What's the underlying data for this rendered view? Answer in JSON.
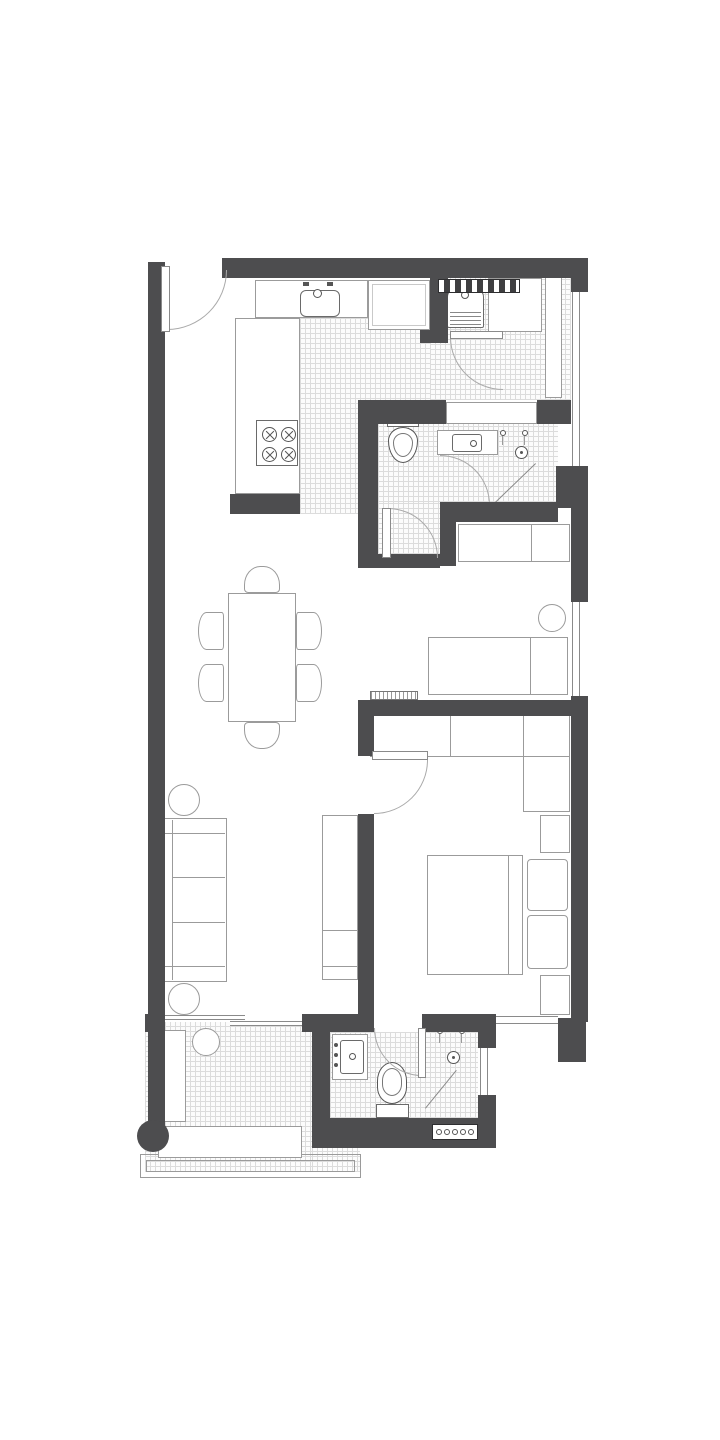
{
  "title": "two-bedroom apartment floor plan",
  "figure_type": "architectural floor plan, top-down, black and white",
  "colors": {
    "bg": "#ffffff",
    "wall": "#4d4d4f",
    "line": "#9b9b9b",
    "fix": "#6a6a6a",
    "tile": "#dcdcdc"
  },
  "rooms": [
    {
      "id": "entry",
      "fixtures": [
        "entry-door-swing"
      ]
    },
    {
      "id": "kitchen",
      "floor": "tile",
      "fixtures": [
        "l-shaped-counter",
        "sink-with-taps",
        "fridge",
        "cooktop-4-burners"
      ]
    },
    {
      "id": "laundry",
      "floor": "tile",
      "fixtures": [
        "vent-grille",
        "washing-machine",
        "storage-box",
        "tall-cabinet",
        "door-swing"
      ]
    },
    {
      "id": "bathroom-1",
      "floor": "tile",
      "fixtures": [
        "recessed-shelf",
        "toilet",
        "vanity-sink",
        "shower-taps",
        "shower-head",
        "shower-screen",
        "door-swing"
      ]
    },
    {
      "id": "bedroom-2",
      "fixtures": [
        "wardrobe",
        "stool",
        "bed-desk"
      ]
    },
    {
      "id": "dining",
      "fixtures": [
        "rectangular-table",
        "chairs-x6"
      ]
    },
    {
      "id": "living",
      "fixtures": [
        "sofa-3-seat",
        "round-side-table-x2",
        "tv-unit"
      ]
    },
    {
      "id": "bedroom-1-master",
      "fixtures": [
        "vent-strip",
        "l-shaped-wardrobe",
        "double-bed",
        "pillows-x2",
        "nightstand-x2",
        "door-swing"
      ]
    },
    {
      "id": "ensuite-bathroom",
      "floor": "tile",
      "fixtures": [
        "vanity-sink",
        "toilet",
        "shower-taps",
        "shower-head",
        "shower-screen",
        "vent-grille",
        "window",
        "door-swing"
      ]
    },
    {
      "id": "balcony",
      "floor": "tile",
      "fixtures": [
        "sliding-door",
        "planter-bench-vertical",
        "bench-horizontal",
        "round-table",
        "column",
        "railing"
      ]
    }
  ],
  "windows": {
    "right_wall": 2,
    "master_bottom": 1,
    "ensuite_right": 1
  },
  "doors": {
    "hinged": 5,
    "sliding": 1
  }
}
